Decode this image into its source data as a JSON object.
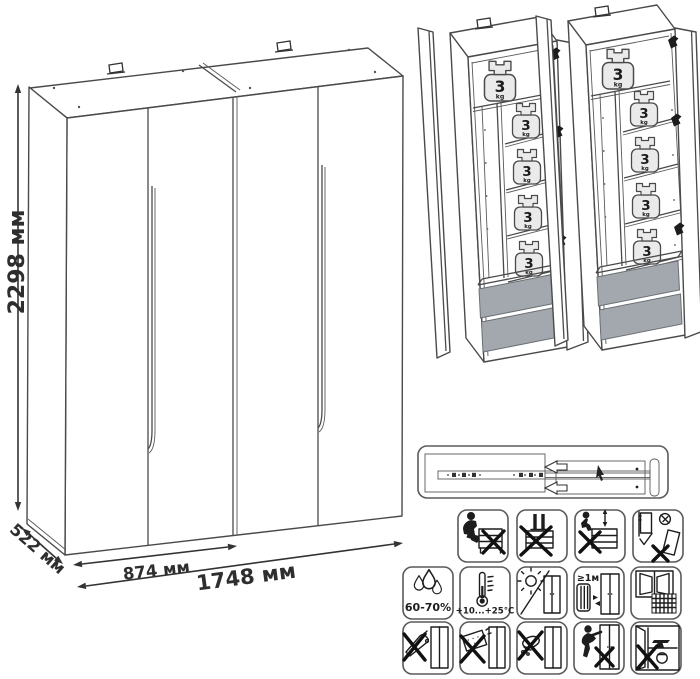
{
  "diagram": {
    "dimensions": {
      "height": "2298 мм",
      "depth": "522 мм",
      "half_width": "874 мм",
      "full_width": "1748 мм"
    },
    "shelf_load": {
      "value": "3",
      "unit": "kg"
    },
    "care": {
      "humidity": "60-70%",
      "temperature": "+10...+25°C",
      "min_distance": "≥1м"
    },
    "colors": {
      "line": "#4a4a4a",
      "icon_line": "#1d1d1d",
      "drawer_fill": "#a2a8ad",
      "weight_fill": "#eaeaea"
    },
    "icons": {
      "panel": "drawer-slide-mechanism",
      "prohibition_row": [
        "no-sitting-on-furniture",
        "no-standing-on-furniture",
        "no-climbing-on-drawers",
        "secure-to-wall-anti-tip"
      ],
      "environment_row": [
        "humidity-range",
        "temperature-range",
        "no-direct-sunlight",
        "distance-from-heat-source",
        "room-ventilation"
      ],
      "cleaning_row": [
        "no-sharp-tools",
        "no-abrasive-cleaners",
        "no-wet-cloth",
        "no-dragging",
        "no-heavy-objects-inside"
      ]
    }
  }
}
